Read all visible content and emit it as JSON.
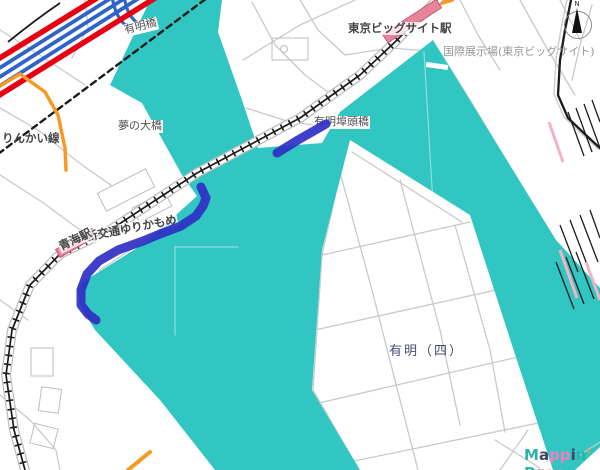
{
  "map": {
    "labels": {
      "ariake_bridge": "有明橋",
      "yume_bridge": "夢の大橋",
      "rinkai_line": "りんかい線",
      "futo_bridge": "有明埠頭橋",
      "big_sight_station": "東京ビッグサイト駅",
      "exhibition_hall": "国際展示場(東京ビッグサイト)",
      "yurikamome_line": "新交通ゆりかもめ",
      "aomi_station": "青海駅",
      "ariake_4": "有明（四）"
    },
    "compass": {
      "label": "N"
    },
    "colors": {
      "water": "#31c6c2",
      "land": "#ffffff",
      "road": "#c9c9c9",
      "road_edge": "#bfbfbf",
      "highway_red": "#e60012",
      "highway_blue": "#2f63c9",
      "rail": "#1c1c1c",
      "orange_road": "#f59a23",
      "station_fill": "#e8839b",
      "station_stroke": "#c45f7b",
      "route_blue": "#2f2fc4",
      "boundary_pale": "#8fdeda",
      "hatch_pink": "#f3b3c2",
      "building": "#bdbdbd"
    },
    "logo": {
      "text": "Mappin' Drop",
      "letters": [
        {
          "ch": "M",
          "c": "#2bb3ab"
        },
        {
          "ch": "a",
          "c": "#40455e"
        },
        {
          "ch": "p",
          "c": "#f07fc0"
        },
        {
          "ch": "p",
          "c": "#f07fc0"
        },
        {
          "ch": "i",
          "c": "#40455e"
        },
        {
          "ch": "n",
          "c": "#2bb3ab"
        },
        {
          "ch": "'",
          "c": "#f59b2e"
        },
        {
          "ch": " ",
          "c": "#000000"
        },
        {
          "ch": "D",
          "c": "#2bb3ab"
        },
        {
          "ch": "r",
          "c": "#40455e"
        },
        {
          "ch": "o",
          "c": "#f59b2e"
        },
        {
          "ch": "p",
          "c": "#f07fc0"
        }
      ]
    }
  }
}
